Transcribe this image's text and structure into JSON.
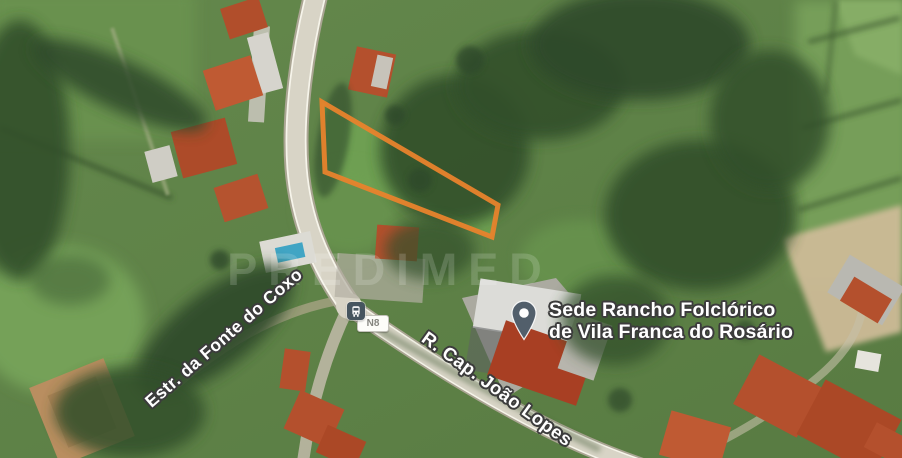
{
  "map": {
    "view": "satellite",
    "watermark_text": "PREDIMED",
    "place_label": {
      "line1": "Sede Rancho Folclórico",
      "line2": "de Vila Franca do Rosário"
    },
    "street_labels": [
      {
        "name": "Estr. da Fonte do Coxo"
      },
      {
        "name": "R. Cap. João Lopes"
      }
    ],
    "road_shield": {
      "label": "N8"
    },
    "markers": [
      {
        "type": "place-pin",
        "color": "#525f6b"
      },
      {
        "type": "bus-stop",
        "color": "#46555f"
      }
    ],
    "plot_outline": {
      "color": "#E8832C",
      "stroke_width": 5,
      "points": [
        [
          322,
          102
        ],
        [
          498,
          205
        ],
        [
          492,
          237
        ],
        [
          325,
          172
        ]
      ]
    },
    "colors": {
      "grass": "#5f8248",
      "woods": "#33502c",
      "road": "#d8d4c6",
      "roof_red": "#b4502d",
      "label_text": "#ffffff",
      "label_halo": "#3c3c3c"
    }
  }
}
